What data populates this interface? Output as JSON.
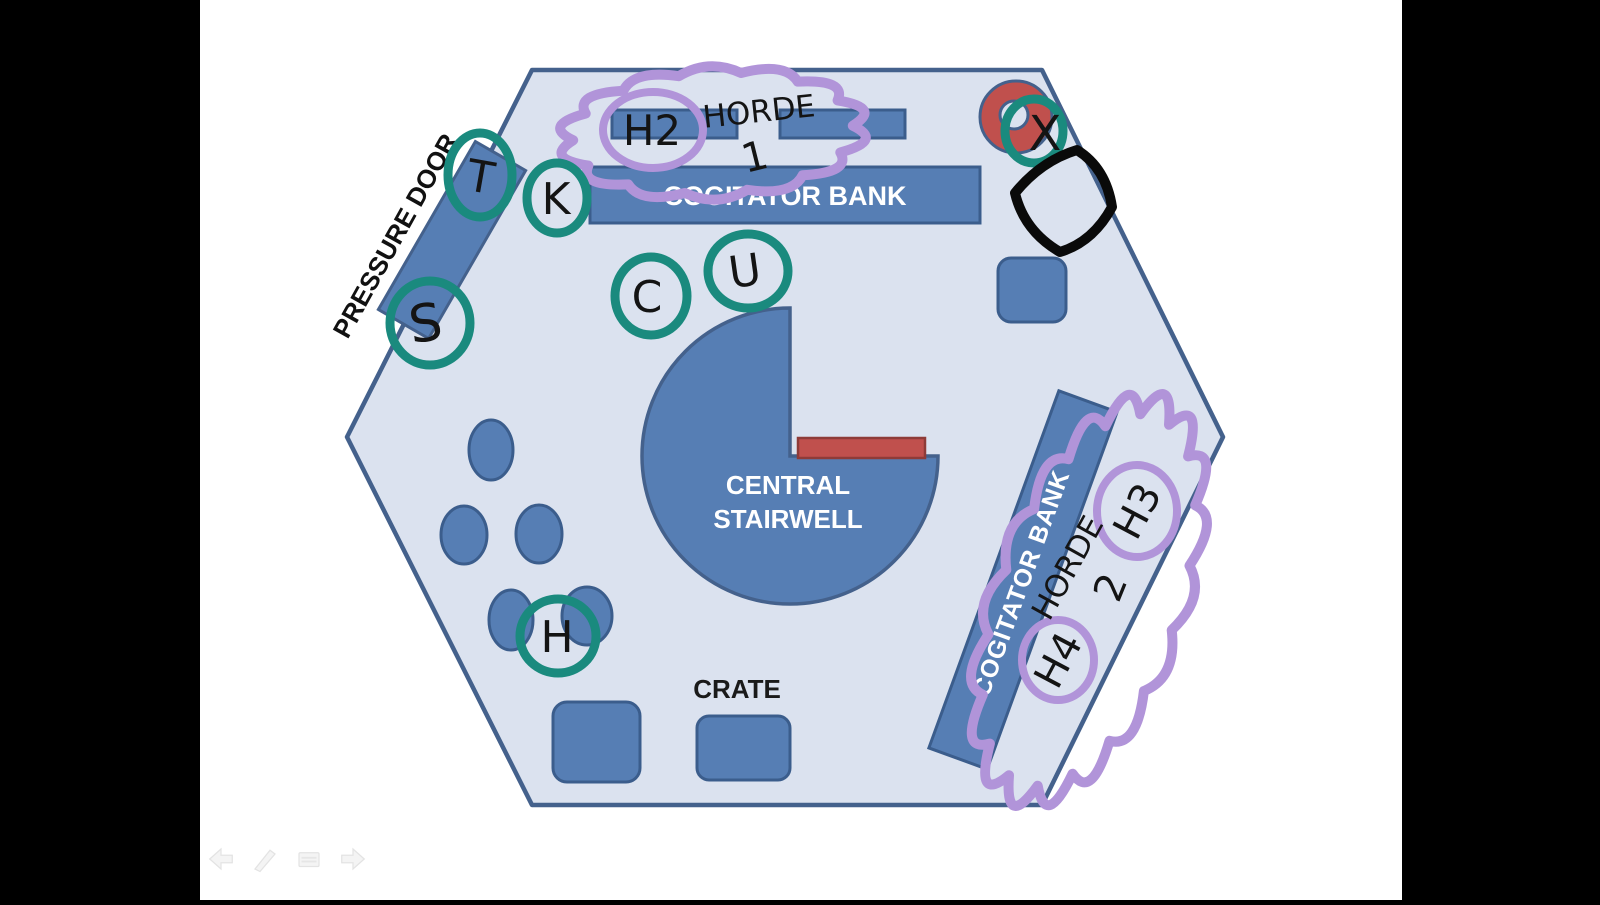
{
  "map": {
    "central_stairwell": {
      "line1": "CENTRAL",
      "line2": "STAIRWELL"
    },
    "cogitator_bank_top_label": "COGITATOR BANK",
    "cogitator_bank_right_label": "COGITATOR BANK",
    "pressure_door_label": "PRESSURE DOOR",
    "crate_label": "CRATE"
  },
  "annotations": {
    "teal_tokens": {
      "t": "T",
      "k": "K",
      "s": "S",
      "c": "C",
      "u": "U",
      "h": "H"
    },
    "x_mark": "X",
    "horde1": {
      "word": "HORDE",
      "number": "1",
      "token": "H2"
    },
    "horde2": {
      "word": "HORDE",
      "number": "2",
      "token_top": "H3",
      "token_bottom": "H4"
    }
  },
  "colors": {
    "floor": "#dbe2ef",
    "outline": "#44618c",
    "furniture": "#567eb4",
    "hazard_red": "#c0504d",
    "marker_teal": "#1a8a7e",
    "marker_purple": "#b194d9",
    "marker_black": "#141414",
    "letterbox": "#000000"
  },
  "presenter_toolbar": {
    "icons": [
      "previous-slide-arrow",
      "pen-tool",
      "slide-menu",
      "next-slide-arrow"
    ]
  }
}
